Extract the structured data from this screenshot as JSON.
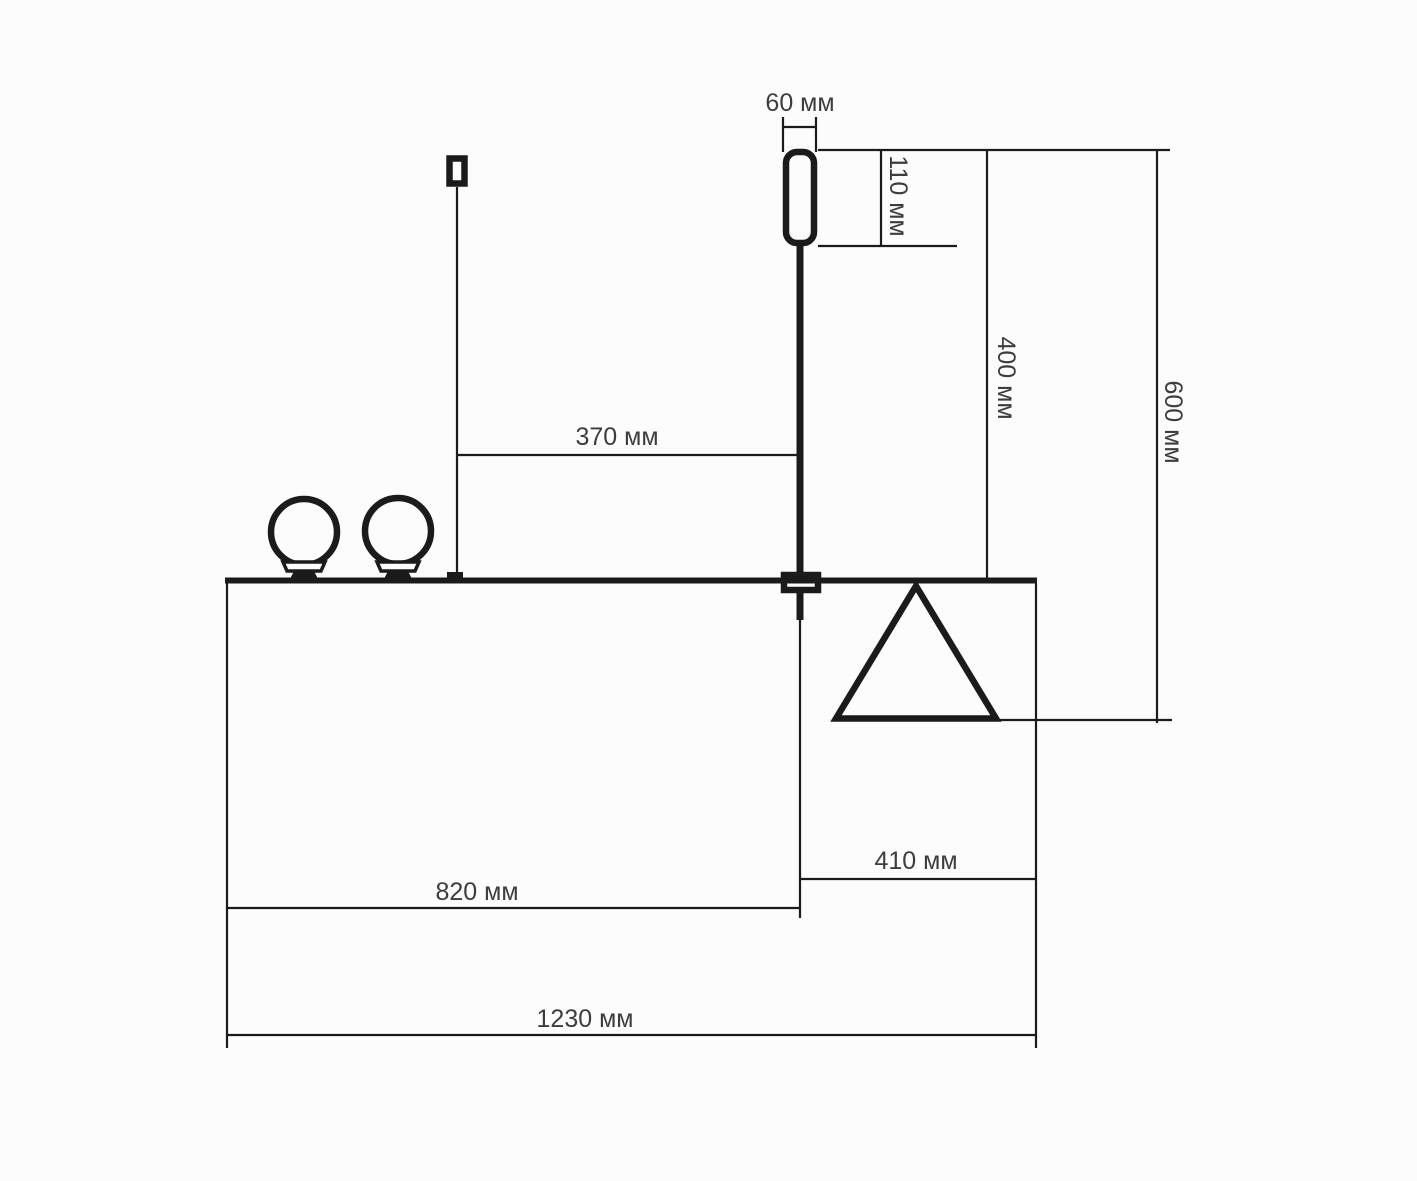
{
  "drawing": {
    "kind": "technical-dimension-drawing",
    "units": "мм"
  },
  "colors": {
    "line": "#1b1b1b",
    "text": "#3d3d3d",
    "bg": "#fcfcfc"
  },
  "dimensions": {
    "capsule_width": {
      "label": "60 мм",
      "value": 60,
      "orientation": "horizontal"
    },
    "capsule_height": {
      "label": "110 мм",
      "value": 110,
      "orientation": "vertical"
    },
    "mast_to_pole": {
      "label": "370 мм",
      "value": 370,
      "orientation": "horizontal"
    },
    "pole_height": {
      "label": "400 мм",
      "value": 400,
      "orientation": "vertical"
    },
    "overall_height": {
      "label": "600 мм",
      "value": 600,
      "orientation": "vertical"
    },
    "right_offset": {
      "label": "410 мм",
      "value": 410,
      "orientation": "horizontal"
    },
    "left_span": {
      "label": "820 мм",
      "value": 820,
      "orientation": "horizontal"
    },
    "overall_width": {
      "label": "1230 мм",
      "value": 1230,
      "orientation": "horizontal"
    }
  }
}
